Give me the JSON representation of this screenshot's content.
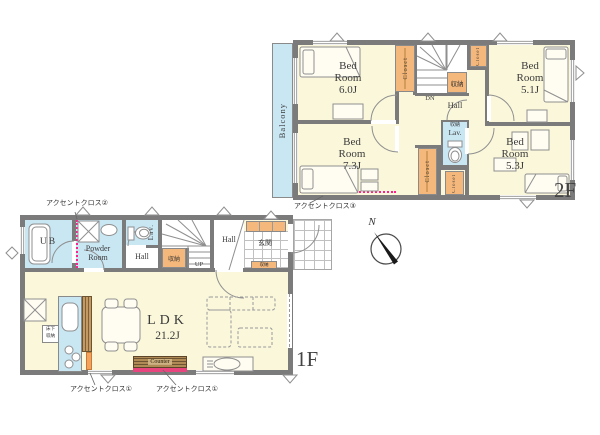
{
  "colors": {
    "wall": "#7b7b7b",
    "floor": "#faf7da",
    "wet_area": "#c9e6f3",
    "closet_orange": "#f5b87c",
    "accent_pink_dotted": "#ff1f8f",
    "counter_pink_strip": "#e8457f",
    "kitchen_orange_strip": "#f5a35c",
    "wood_counter": "#b08a55"
  },
  "compass": {
    "north_label": "N"
  },
  "floor2": {
    "floor_label": "2F",
    "balcony_label": "Balcony",
    "hall_label": "Hall",
    "stairs_label": "DN",
    "storage_label": "収納",
    "closet_label": "Closet",
    "lav_label": "Lav.",
    "lav_storage_label": "収納",
    "accent_label": "アクセントクロス③",
    "bedrooms": [
      {
        "name_l1": "Bed",
        "name_l2": "Room",
        "size": "6.0J"
      },
      {
        "name_l1": "Bed",
        "name_l2": "Room",
        "size": "5.1J"
      },
      {
        "name_l1": "Bed",
        "name_l2": "Room",
        "size": "7.3J"
      },
      {
        "name_l1": "Bed",
        "name_l2": "Room",
        "size": "5.3J"
      }
    ]
  },
  "floor1": {
    "floor_label": "1F",
    "bath_label": "UB",
    "powder_l1": "Powder",
    "powder_l2": "Room",
    "lav_label": "Lav.",
    "hall_label": "Hall",
    "storage_label": "収納",
    "stairs_label": "UP",
    "entrance_hall_label": "Hall",
    "entrance_label": "玄関",
    "entrance_storage_label": "収納",
    "ldk_label": "LDK",
    "ldk_size": "21.2J",
    "underfloor_l1": "床下",
    "underfloor_l2": "収納",
    "counter_label": "Counter",
    "accent1_left_label": "アクセントクロス①",
    "accent1_right_label": "アクセントクロス①",
    "accent2_label": "アクセントクロス②"
  }
}
